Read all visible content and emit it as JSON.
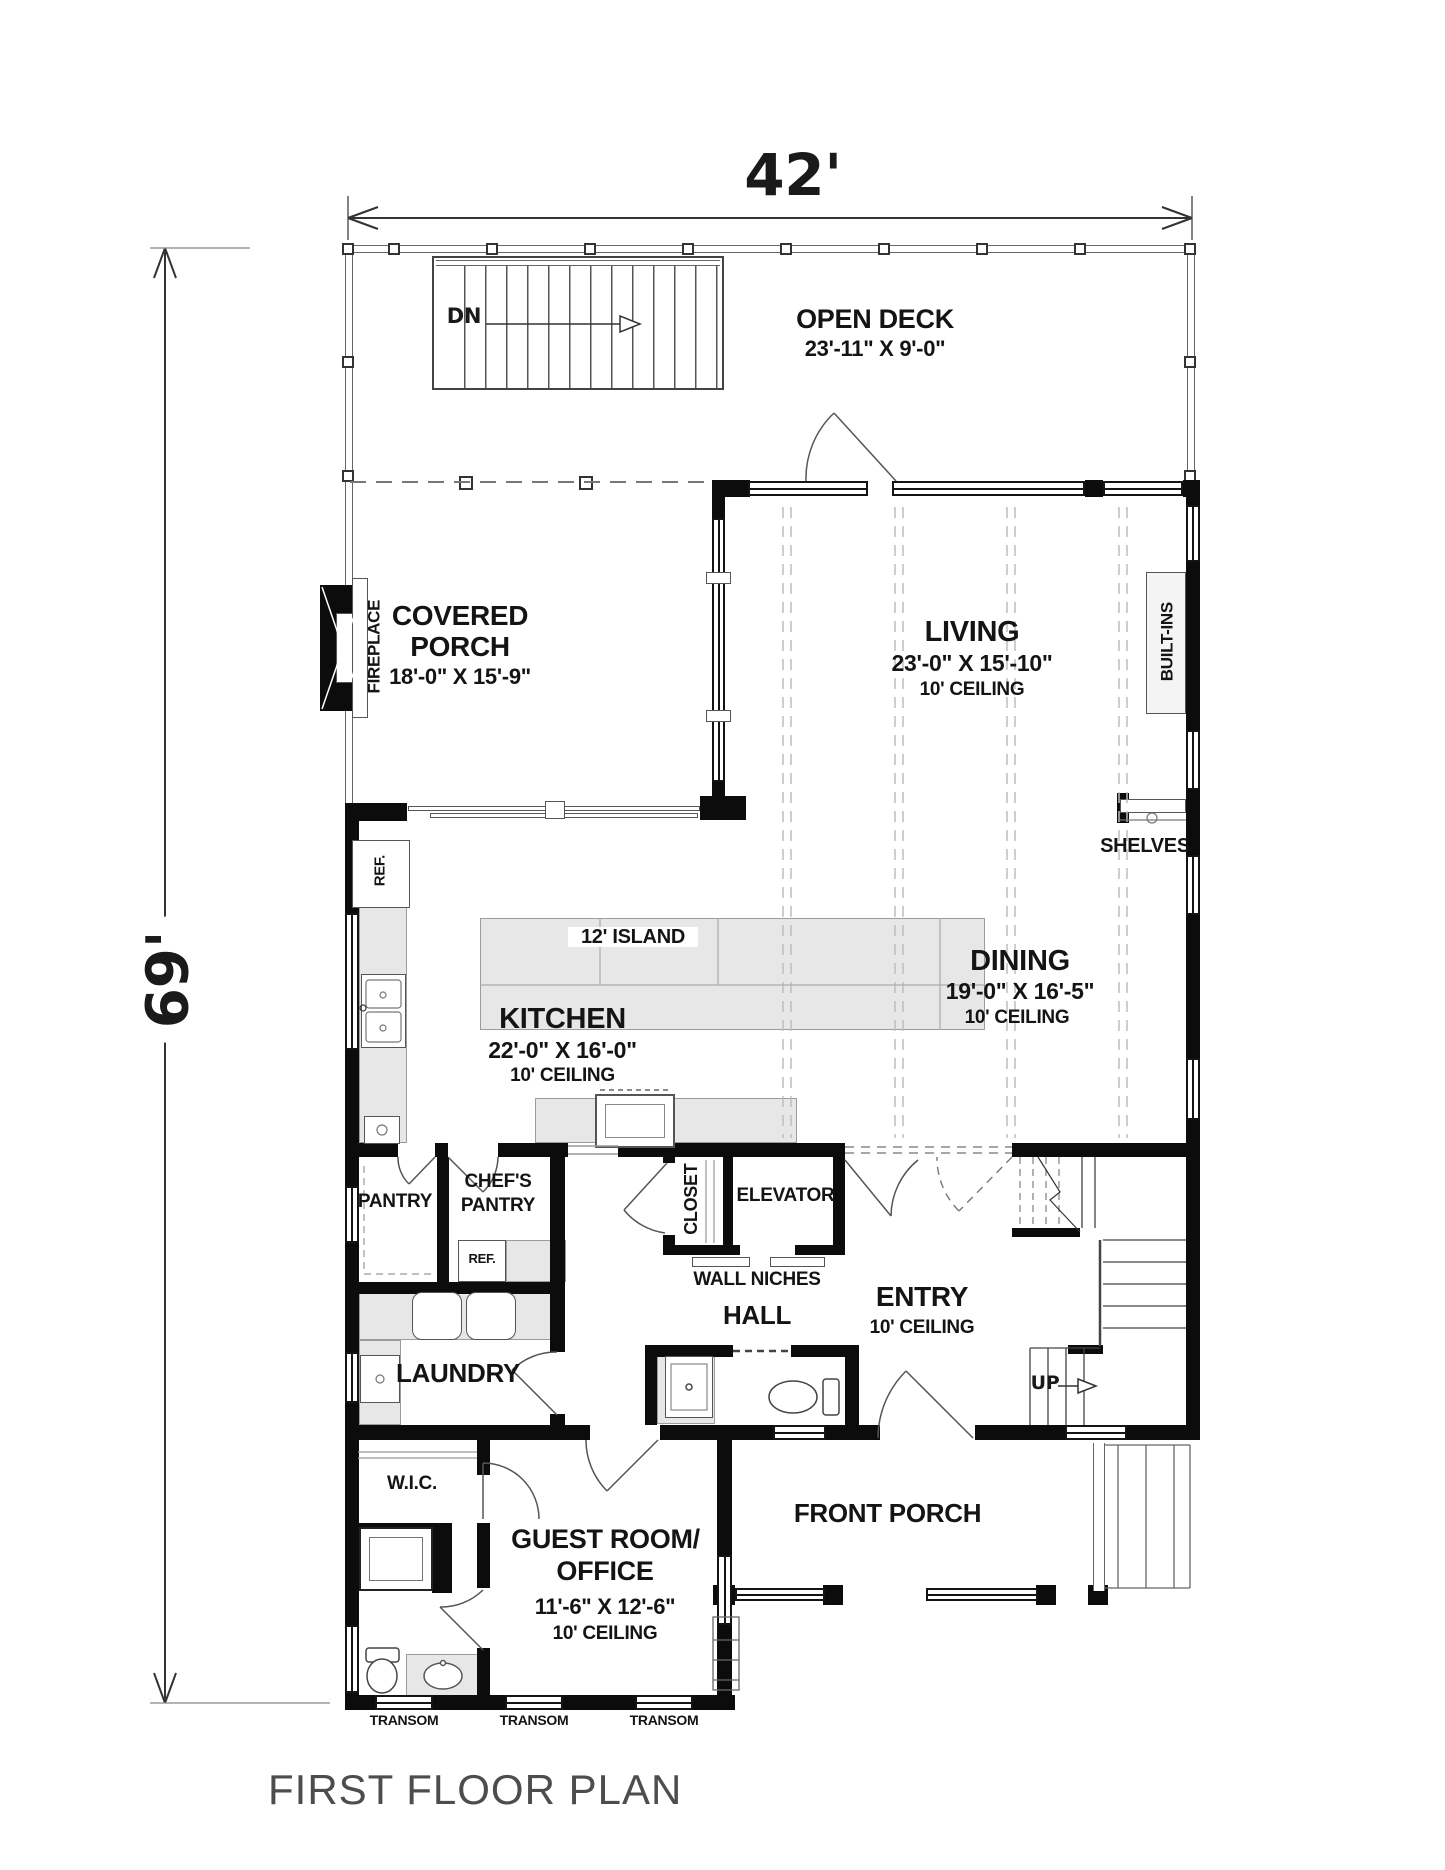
{
  "title": "FIRST FLOOR PLAN",
  "dimensions": {
    "width": "42'",
    "height": "69'"
  },
  "rooms": {
    "open_deck": {
      "name": "OPEN DECK",
      "size": "23'-11\" X 9'-0\""
    },
    "covered_porch": {
      "line1": "COVERED",
      "line2": "PORCH",
      "size": "18'-0\" X 15'-9\""
    },
    "living": {
      "name": "LIVING",
      "size": "23'-0\" X 15'-10\"",
      "ceiling": "10' CEILING"
    },
    "dining": {
      "name": "DINING",
      "size": "19'-0\" X 16'-5\"",
      "ceiling": "10' CEILING"
    },
    "kitchen": {
      "name": "KITCHEN",
      "size": "22'-0\" X 16'-0\"",
      "ceiling": "10' CEILING"
    },
    "pantry": {
      "name": "PANTRY"
    },
    "chefs_pantry": {
      "line1": "CHEF'S",
      "line2": "PANTRY"
    },
    "closet": {
      "name": "CLOSET"
    },
    "elevator": {
      "name": "ELEVATOR"
    },
    "hall": {
      "name": "HALL"
    },
    "entry": {
      "name": "ENTRY",
      "ceiling": "10' CEILING"
    },
    "laundry": {
      "name": "LAUNDRY"
    },
    "wic": {
      "name": "W.I.C."
    },
    "guest_room": {
      "line1": "GUEST ROOM/",
      "line2": "OFFICE",
      "size": "11'-6\" X 12'-6\"",
      "ceiling": "10' CEILING"
    },
    "front_porch": {
      "name": "FRONT PORCH"
    }
  },
  "features": {
    "fireplace": "FIREPLACE",
    "built_ins": "BUILT-INS",
    "shelves": "SHELVES",
    "island": "12' ISLAND",
    "wall_niches": "WALL NICHES",
    "kitchen_ref": "REF.",
    "pantry_ref": "REF.",
    "stair_down": "DN",
    "stair_up": "UP",
    "transoms": [
      "TRANSOM",
      "TRANSOM",
      "TRANSOM"
    ]
  }
}
